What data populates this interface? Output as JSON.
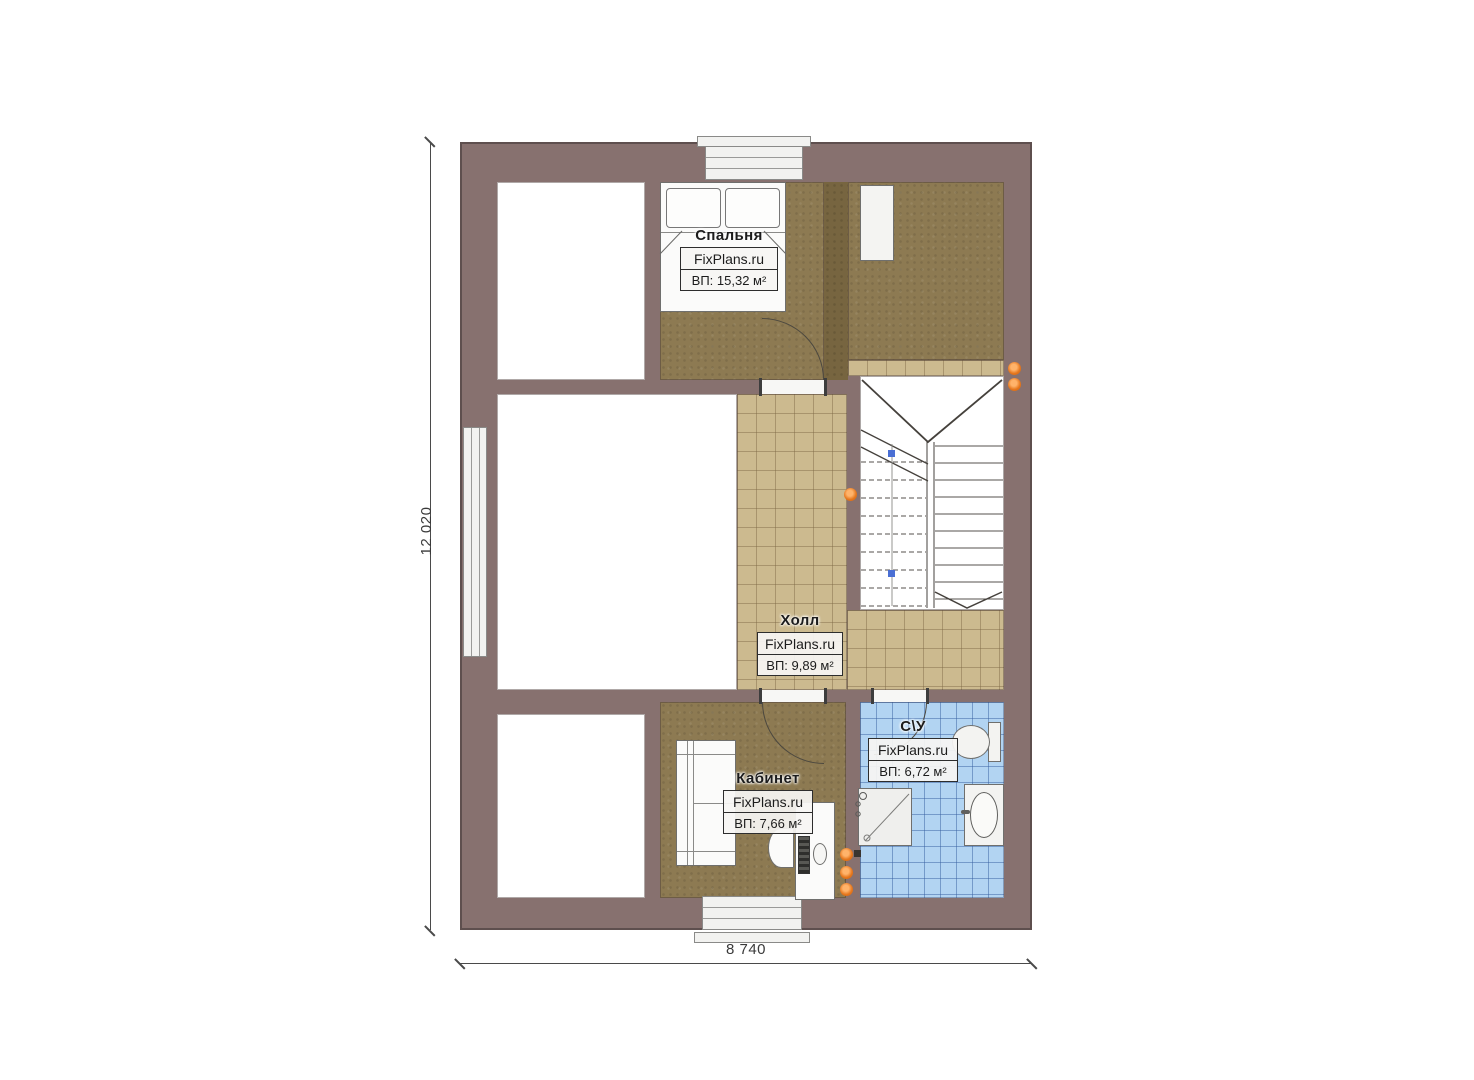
{
  "plan": {
    "type": "floor-plan",
    "rooms": {
      "bedroom": {
        "title": "Спальня",
        "watermark": "FixPlans.ru",
        "area": "ВП: 15,32 м²"
      },
      "hall": {
        "title": "Холл",
        "watermark": "FixPlans.ru",
        "area": "ВП: 9,89 м²"
      },
      "office": {
        "title": "Кабинет",
        "watermark": "FixPlans.ru",
        "area": "ВП: 7,66 м²"
      },
      "bathroom": {
        "title": "С\\У",
        "watermark": "FixPlans.ru",
        "area": "ВП: 6,72 м²"
      }
    },
    "dimensions": {
      "vertical": "12 020",
      "horizontal": "8 740"
    },
    "colors": {
      "wall": "#87716f",
      "wood_floor": "#8d7a52",
      "hall_tile": "#ccba8f",
      "bath_tile": "#b2d4f2",
      "marker_orange": "#e5761c",
      "stair_marker_blue": "#4a6fd4",
      "background": "#ffffff"
    }
  }
}
